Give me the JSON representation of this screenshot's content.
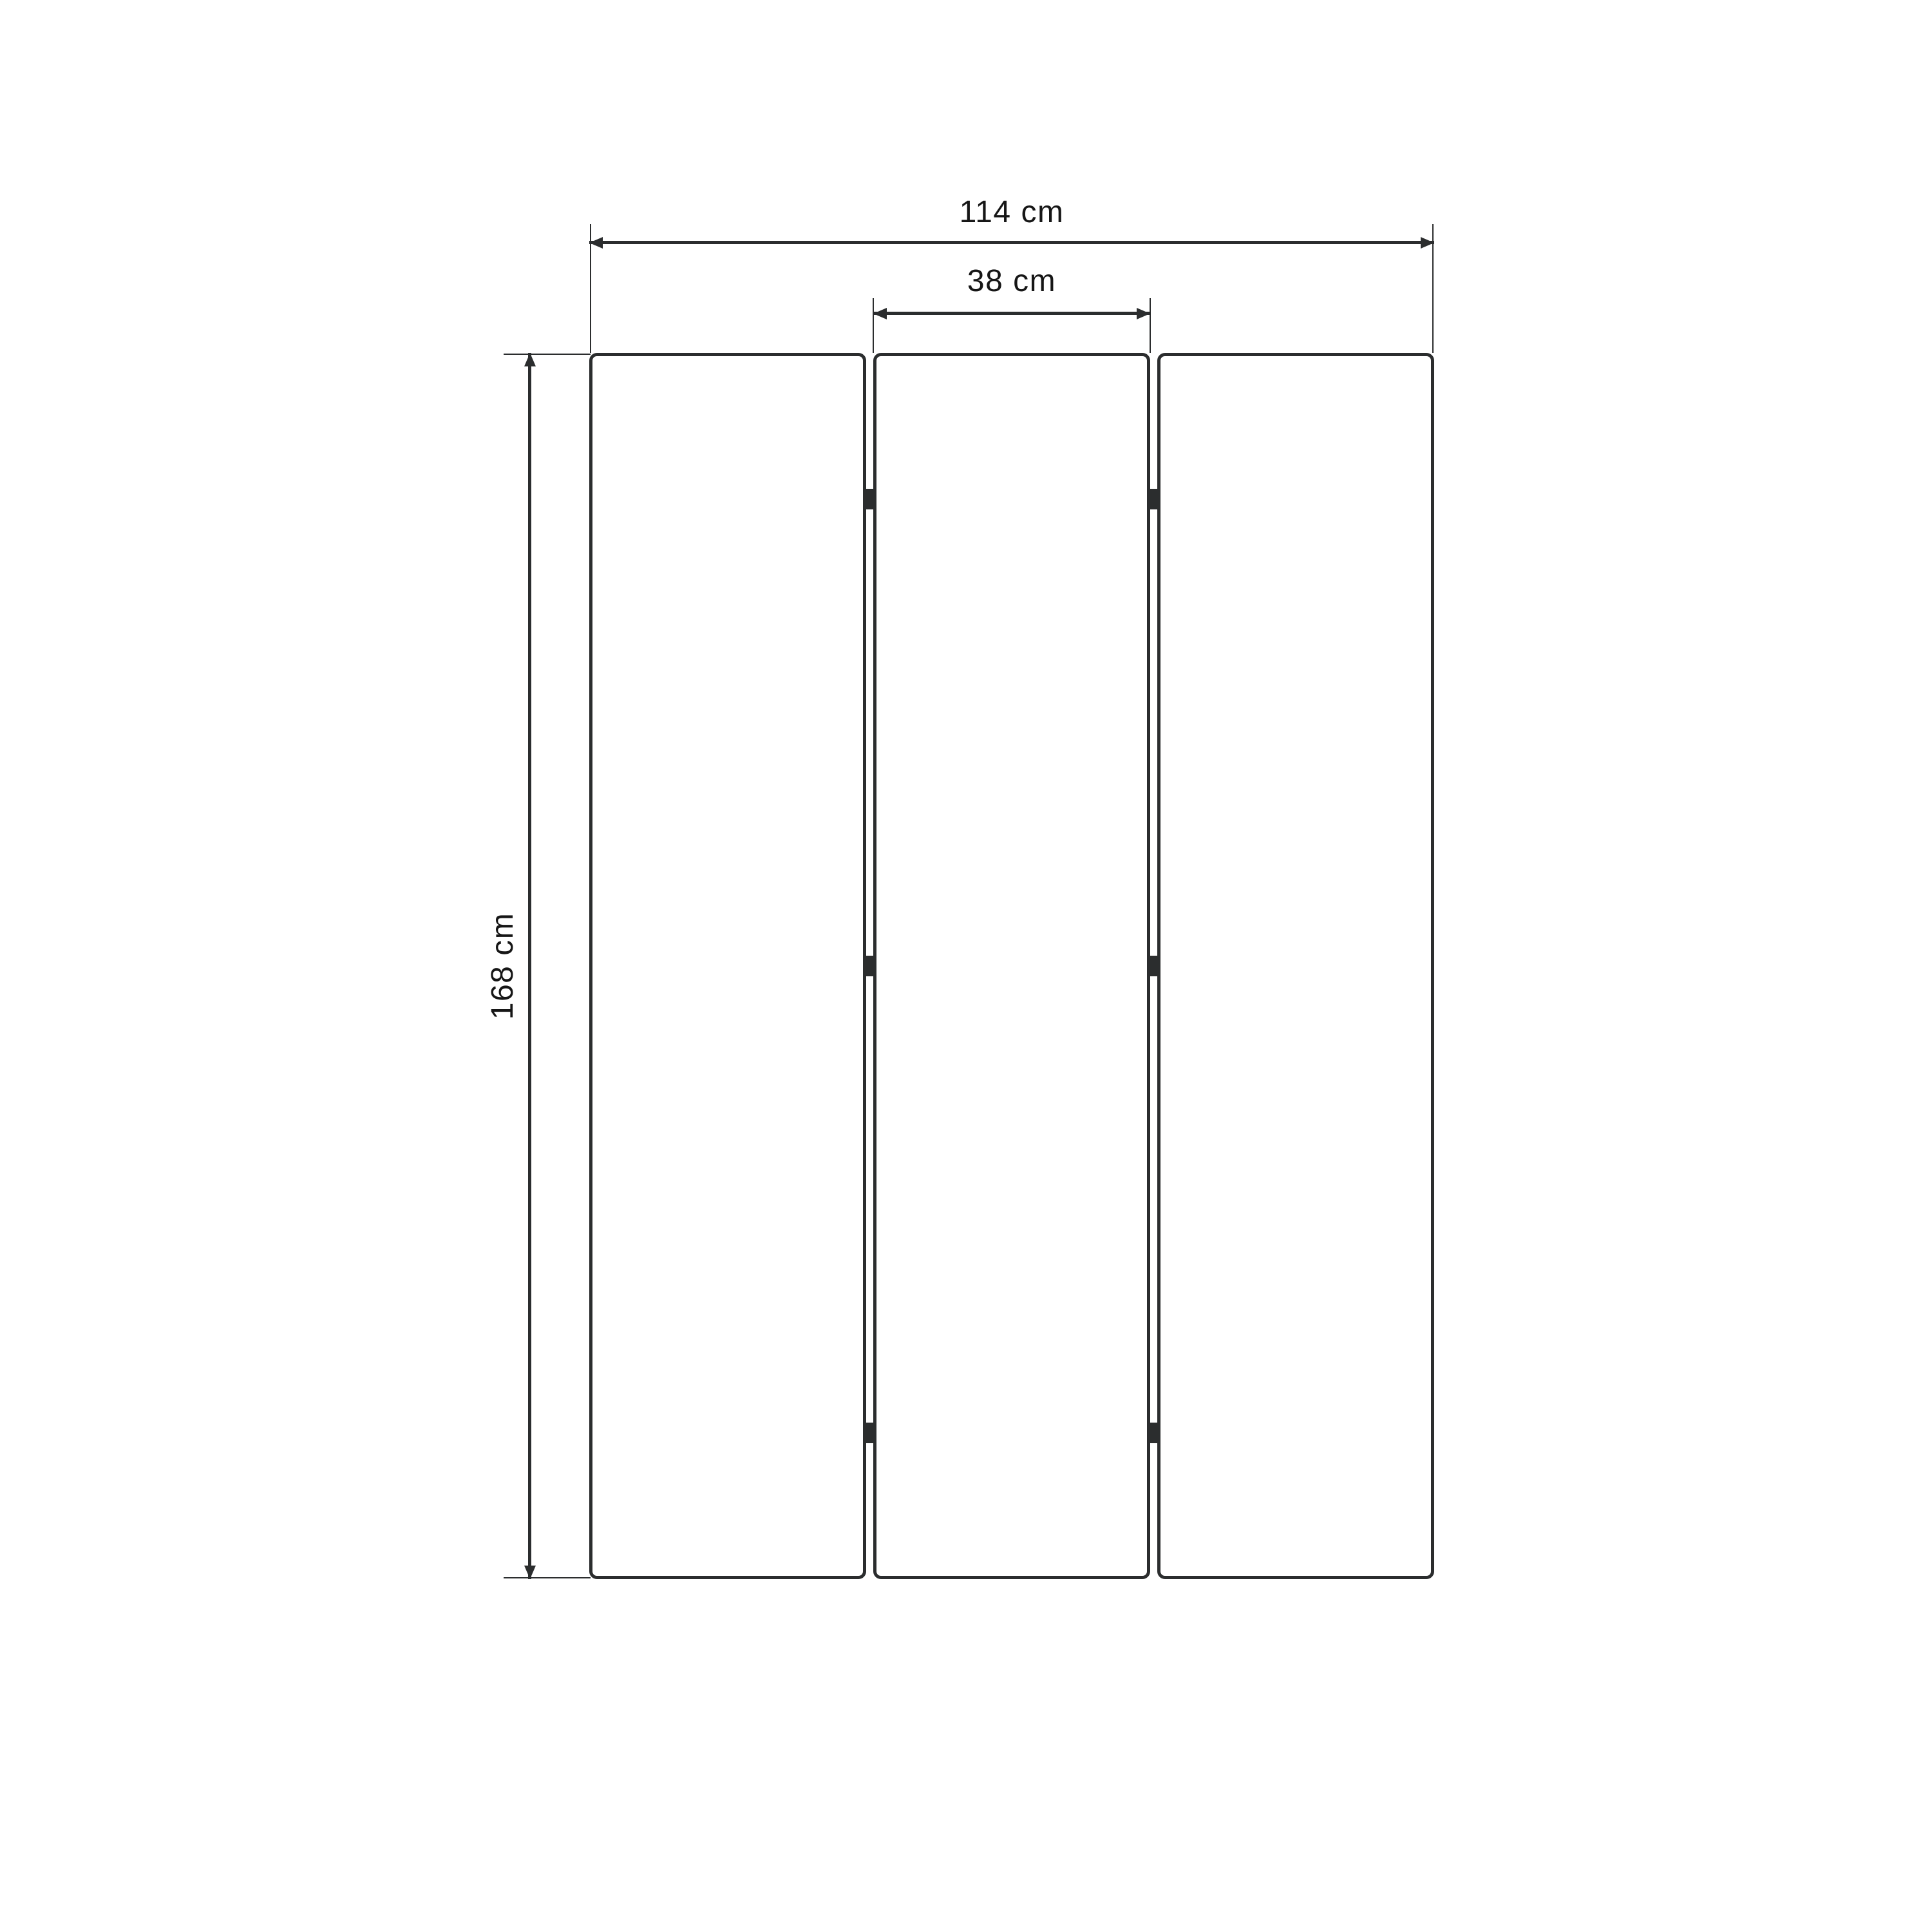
{
  "figure": {
    "type": "furniture-dimension-diagram",
    "subject": "three-panel folding screen front view",
    "background_color": "#ffffff",
    "line_color": "#2b2d2e",
    "text_color": "#161616",
    "panel_count": 3,
    "hinge_count": 6,
    "labels": {
      "total_width": "114 cm",
      "panel_width": "38 cm",
      "height": "168 cm"
    }
  }
}
